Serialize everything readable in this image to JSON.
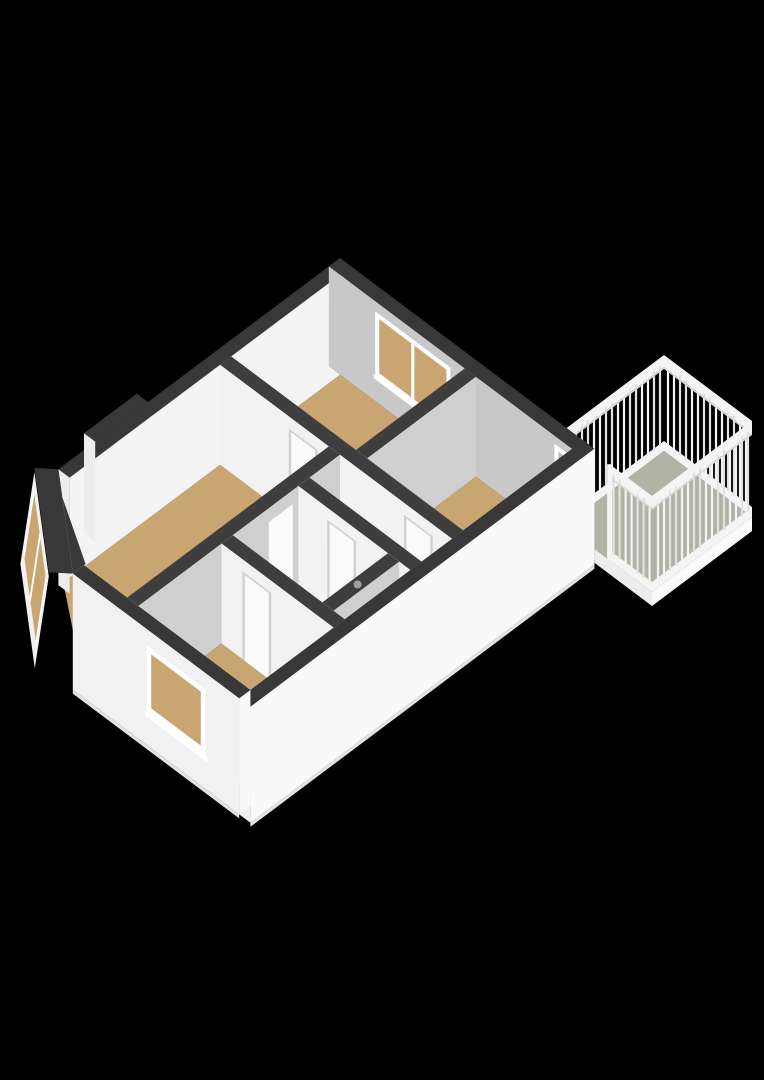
{
  "app": {
    "view_label": "3D floor plan view",
    "background": "#000000"
  },
  "floorplan": {
    "projection": "axonometric",
    "rooms": [
      {
        "name": "living-room",
        "floor": "wood",
        "features": [
          "bay-window",
          "chimney-recess"
        ]
      },
      {
        "name": "front-bedroom",
        "floor": "wood",
        "features": [
          "double-window"
        ]
      },
      {
        "name": "back-bedroom",
        "floor": "wood",
        "features": [
          "window"
        ]
      },
      {
        "name": "shower-room",
        "floor": "wood",
        "features": [
          "balcony-door"
        ]
      },
      {
        "name": "hallway",
        "floor": "light",
        "features": [
          "door-frames",
          "door-knob"
        ]
      },
      {
        "name": "bathroom",
        "floor": "light",
        "features": []
      }
    ],
    "exterior": [
      "balcony",
      "balcony-railing",
      "railing-gap-post",
      "bay-window-prism"
    ]
  },
  "colors": {
    "background": "#000000",
    "wallTopExt": "#383838",
    "wallTopInt": "#3e3e3e",
    "extSE": "#f9f9f9",
    "extSW": "#f1f1f1",
    "extSmall": "#ededed",
    "inNE": "#c8c8c8",
    "inNW": "#f4f4f4",
    "intE": "#cfcfcf",
    "intS": "#f2f2f2",
    "wood": "#c9a572",
    "light": "#ebebeb",
    "balconyFloor": "#b1b3a4",
    "glassDoor": "#b9bdaf",
    "frame": "#ffffff",
    "doorFill": "#fbfbfb",
    "jamb": "#d0d0d0",
    "railWhite": "#f4f4f4",
    "railShade": "#e2e2e2",
    "railEdge": "#d9d9d9",
    "baseSkirt": "#e4e4e4",
    "knob": "#a0a0a0"
  }
}
